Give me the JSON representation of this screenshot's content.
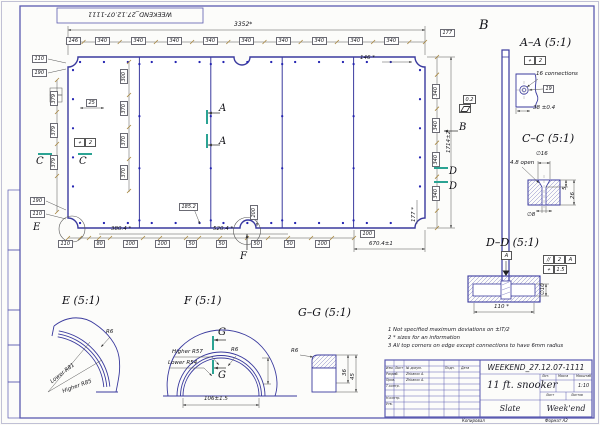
{
  "sheet": {
    "stamp": "WEEKEND_27.12.07-1111",
    "copied": "Копировал",
    "format": "Формат А2"
  },
  "plan": {
    "overall_w": "3352*",
    "overall_h": "1714±2",
    "seg340": "340",
    "seg146": "146",
    "seg177": "177",
    "d146s": "146 *",
    "d177s": "177 *",
    "l110": "110",
    "l190": "190",
    "l379": "379",
    "l300": "300",
    "l370": "370",
    "l25": "25",
    "b110": "110",
    "b80": "80",
    "b100": "100",
    "b50": "50",
    "b3804": "380.4 *",
    "b5204": "520.4 *",
    "b6704": "670.4±1",
    "b1852": "185.2",
    "b200": "200",
    "pos_sym": "⌖",
    "pos_val": "2",
    "flat_val": "0.2",
    "A": "A",
    "B": "B",
    "C": "C",
    "D": "D",
    "E": "E",
    "F": "F"
  },
  "viewB": {
    "label": "B"
  },
  "secAA": {
    "title": "A–A (5:1)",
    "pos_sym": "⌖",
    "pos_val": "2",
    "conn": "16 connections",
    "d19": "19",
    "d38": "38 ±0.4"
  },
  "secCC": {
    "title": "C–C (5:1)",
    "d16": "∅16",
    "open": "4.8 open",
    "d8": "∅8",
    "t5": "5",
    "t26": "26"
  },
  "secDD": {
    "title": "D–D (5:1)",
    "datum": "A",
    "par_sym": "//",
    "par_val": "2",
    "par_ref": "A",
    "pos_sym": "⌖",
    "pos_val": "1.5",
    "d110": "110 *",
    "d10": "∅10"
  },
  "secE": {
    "title": "E (5:1)",
    "r6": "R6",
    "lower": "Lower R81",
    "higher": "Higher R85"
  },
  "secF": {
    "title": "F (5:1)",
    "higher": "Higher R57",
    "lower": "Lower R54",
    "r6": "R6",
    "dim": "106±1.5",
    "g": "G"
  },
  "secGG": {
    "title": "G–G (5:1)",
    "r6": "R6",
    "d36": "36",
    "d45": "45"
  },
  "notes": {
    "n1": "1  Not specified maximum deviations on ±IT/2",
    "n2": "2  * sizes for an information",
    "n3": "3  All top corners on edge except connections to have 6mm radius"
  },
  "tb": {
    "doc": "WEEKEND_27.12.07-1111",
    "name": "11 ft. snooker",
    "part": "Slate",
    "company": "Week'end",
    "scale": "1:10",
    "h_izm": "Изм.",
    "h_list": "Лист",
    "h_doc": "№ докум.",
    "h_podp": "Подп.",
    "h_data": "Дата",
    "r1": "Разраб.",
    "r2": "Пров.",
    "r3": "Т.контр.",
    "r4": "Н.контр.",
    "r5": "Утв.",
    "name1": "Zhbanov A.",
    "name2": "Zhbanov A.",
    "h_lit": "Лит.",
    "h_mass": "Масса",
    "h_scale": "Масштаб",
    "h_sheet": "Лист",
    "h_sheets": "Листов"
  }
}
